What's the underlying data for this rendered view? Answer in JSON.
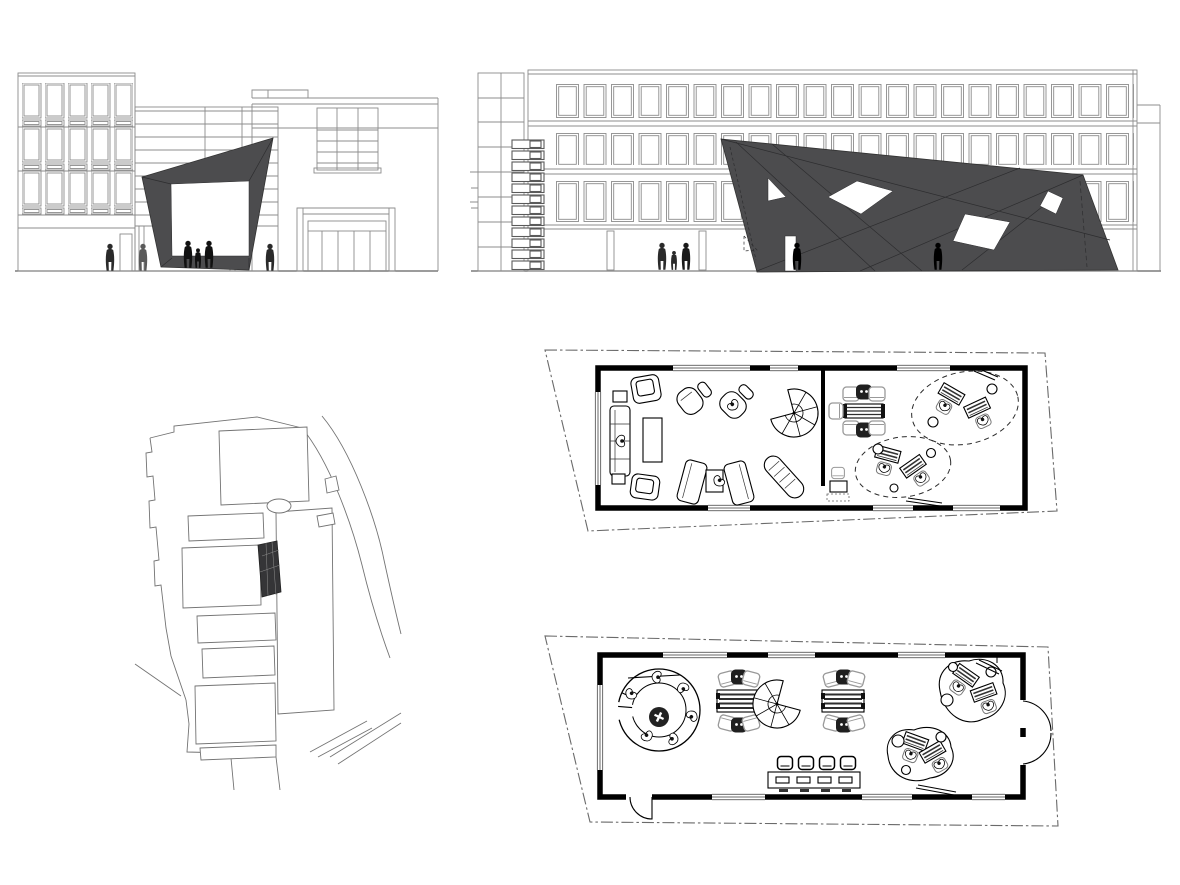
{
  "canvas": {
    "width": 1180,
    "height": 885,
    "background": "#ffffff"
  },
  "colors": {
    "background": "#ffffff",
    "elevation_line": "#8c8c8c",
    "elevation_line_strong": "#606060",
    "dark_fill": "#4c4c4e",
    "dark_fill_site": "#353537",
    "plan_line": "#000000",
    "boundary_dash": "#6a6a6a",
    "site_line": "#737373",
    "figure_dark": "#1c1c1c",
    "chair_light": "#999999"
  },
  "panels": [
    {
      "id": "elevation-entry",
      "name": "entry-elevation"
    },
    {
      "id": "elevation-street",
      "name": "street-elevation"
    },
    {
      "id": "site-plan",
      "name": "site-plan"
    },
    {
      "id": "floor-plan-upper",
      "name": "upper-floor-plan"
    },
    {
      "id": "floor-plan-ground",
      "name": "ground-floor-plan"
    }
  ]
}
